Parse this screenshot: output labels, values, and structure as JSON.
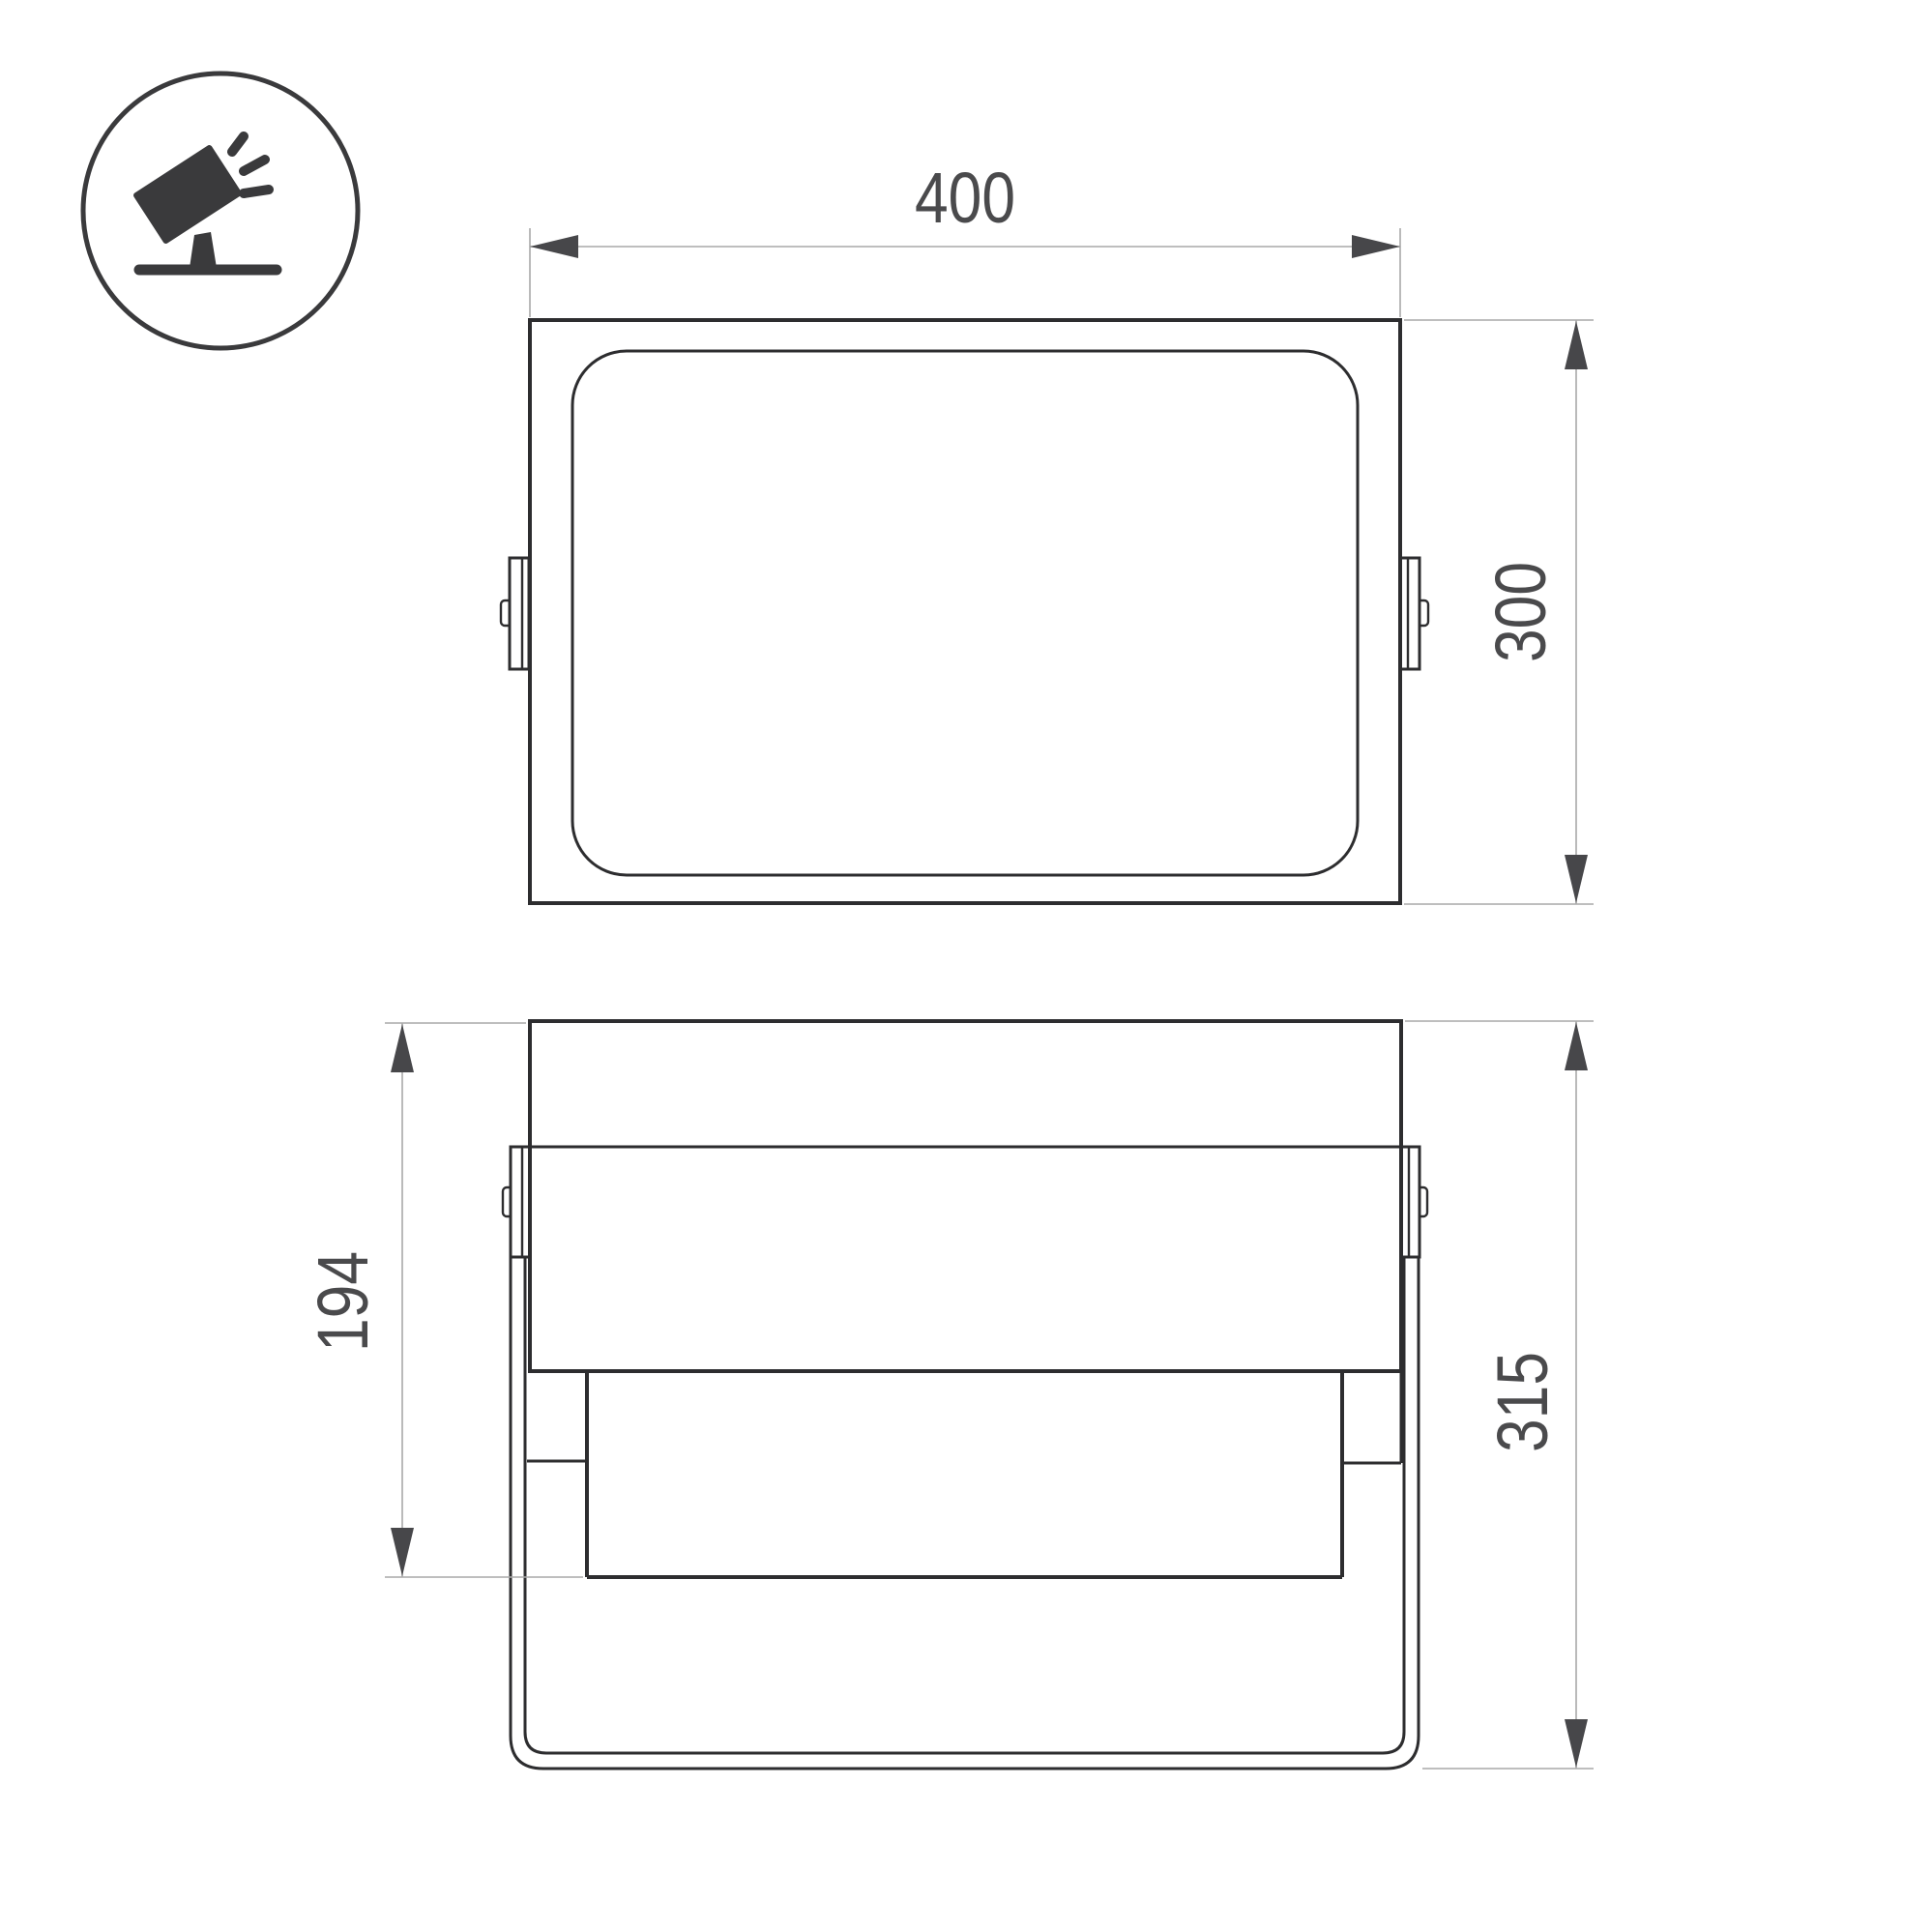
{
  "page": {
    "background_color": "#ffffff",
    "description": "Technical dimension drawing of a floodlight luminaire, two orthographic views"
  },
  "icon": {
    "name": "tilted-floodlight-on-stand",
    "color": "#3a3a3c"
  },
  "drawing": {
    "stroke_color": "#2d2d2f",
    "dim_line_color": "#a9a9a9",
    "arrow_color": "#47474a",
    "text_color": "#4a4a4c",
    "dimensions": {
      "width": {
        "label": "400"
      },
      "height": {
        "label": "300"
      },
      "front_height": {
        "label": "194"
      },
      "total_height": {
        "label": "315"
      }
    }
  }
}
